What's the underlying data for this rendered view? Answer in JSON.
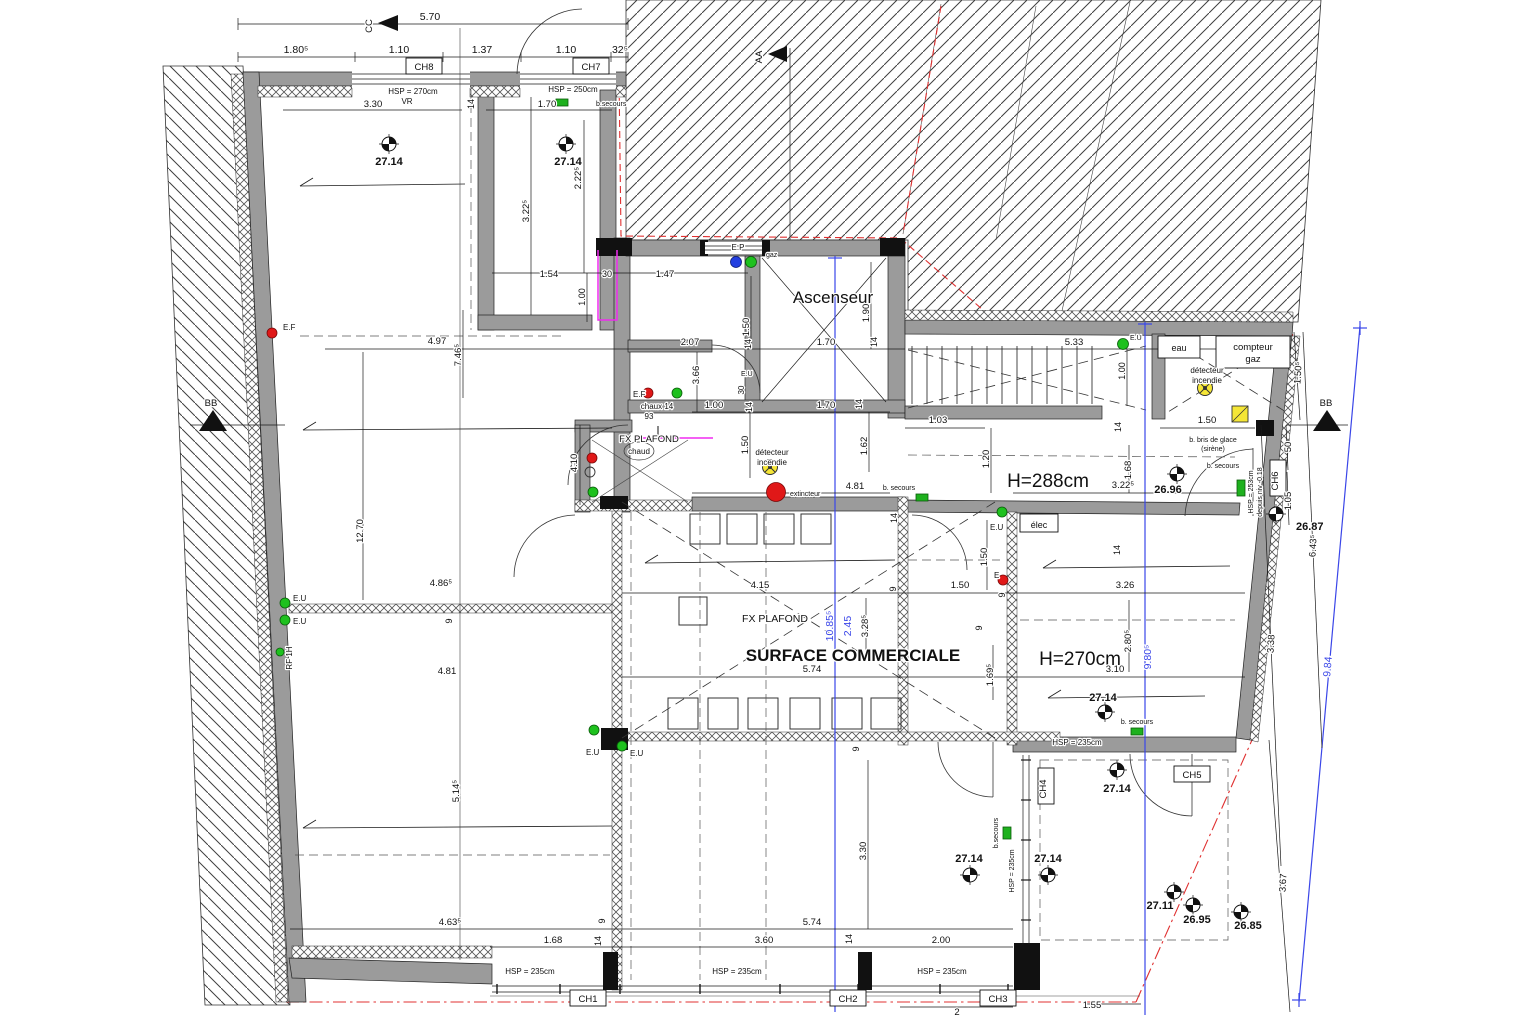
{
  "rooms": {
    "ascenseur": "Ascenseur",
    "surface_commerciale": "SURFACE COMMERCIALE",
    "h288": "H=288cm",
    "h270": "H=270cm"
  },
  "labels": {
    "fx_plafond": "FX PLAFOND",
    "chaud": "chaud",
    "chaux": "chaux 14",
    "vr": "VR",
    "hsp270": "HSP = 270cm",
    "hsp250": "HSP = 250cm",
    "hsp235": "HSP = 235cm",
    "hsp253": "HSP = 253cm",
    "depuis": "depuis niv -0.18",
    "b_secours": "b.secours",
    "b_secours_sp": "b. secours",
    "elec": "élec",
    "eau": "eau",
    "compteur": "compteur",
    "gaz": "gaz",
    "bris": "b. bris de glace",
    "sirene": "(sirène)",
    "detecteur": "détecteur",
    "incendie": "incendie",
    "extincteur": "extincteur",
    "ef": "E.F",
    "eu": "E.U",
    "ep": "E.P",
    "e": "E",
    "rf": "RF 1H"
  },
  "chambers": {
    "ch1": "CH1",
    "ch2": "CH2",
    "ch3": "CH3",
    "ch4": "CH4",
    "ch5": "CH5",
    "ch6": "CH6",
    "ch7": "CH7",
    "ch8": "CH8"
  },
  "sections": {
    "aa": "AA",
    "bb": "BB",
    "cc": "CC"
  },
  "levels": {
    "l2714": "27.14",
    "l2696": "26.96",
    "l2687": "26.87",
    "l2711": "27.11",
    "l2695": "26.95",
    "l2685": "26.85"
  },
  "dims": {
    "v570": "5.70",
    "v180h": "1.80⁵",
    "v110": "1.10",
    "v137": "1.37",
    "v32h": "32⁵",
    "v330": "3.30",
    "v14": "14",
    "v170": "1.70",
    "v222h": "2.22⁵",
    "v322h": "3.22⁵",
    "v154": "1.54",
    "v30": "30",
    "v147": "1.47",
    "v100": "1.00",
    "v207": "2.07",
    "v533": "5.33",
    "v190": "1.90",
    "v150": "1.50",
    "v366": "3.66",
    "v497": "4.97",
    "v746h": "7.46⁵",
    "v103": "1.03",
    "v120": "1.20",
    "v162": "1.62",
    "v410": "4.10",
    "v481": "4.81",
    "v168": "1.68",
    "v326": "3.26",
    "v415": "4.15",
    "v9": "9",
    "v574": "5.74",
    "v310": "3.10",
    "v169h": "1.69⁵",
    "v280h": "2.80⁵",
    "v1085h": "10.85⁵",
    "v245": "2.45",
    "v328h": "3.28⁵",
    "v980h": "9.80⁵",
    "v486h": "4.86⁵",
    "v1270": "12.70",
    "v514h": "5.14⁵",
    "v463h": "4.63⁵",
    "v360": "3.60",
    "v200": "2.00",
    "v2": "2",
    "v155": "1.55",
    "v367": "3.67",
    "v338": "3.38",
    "v643h": "6.43⁵",
    "v150h": "1.50⁵",
    "v50": "50",
    "v105": "1.05",
    "v984": "9.84",
    "v93": "93"
  }
}
